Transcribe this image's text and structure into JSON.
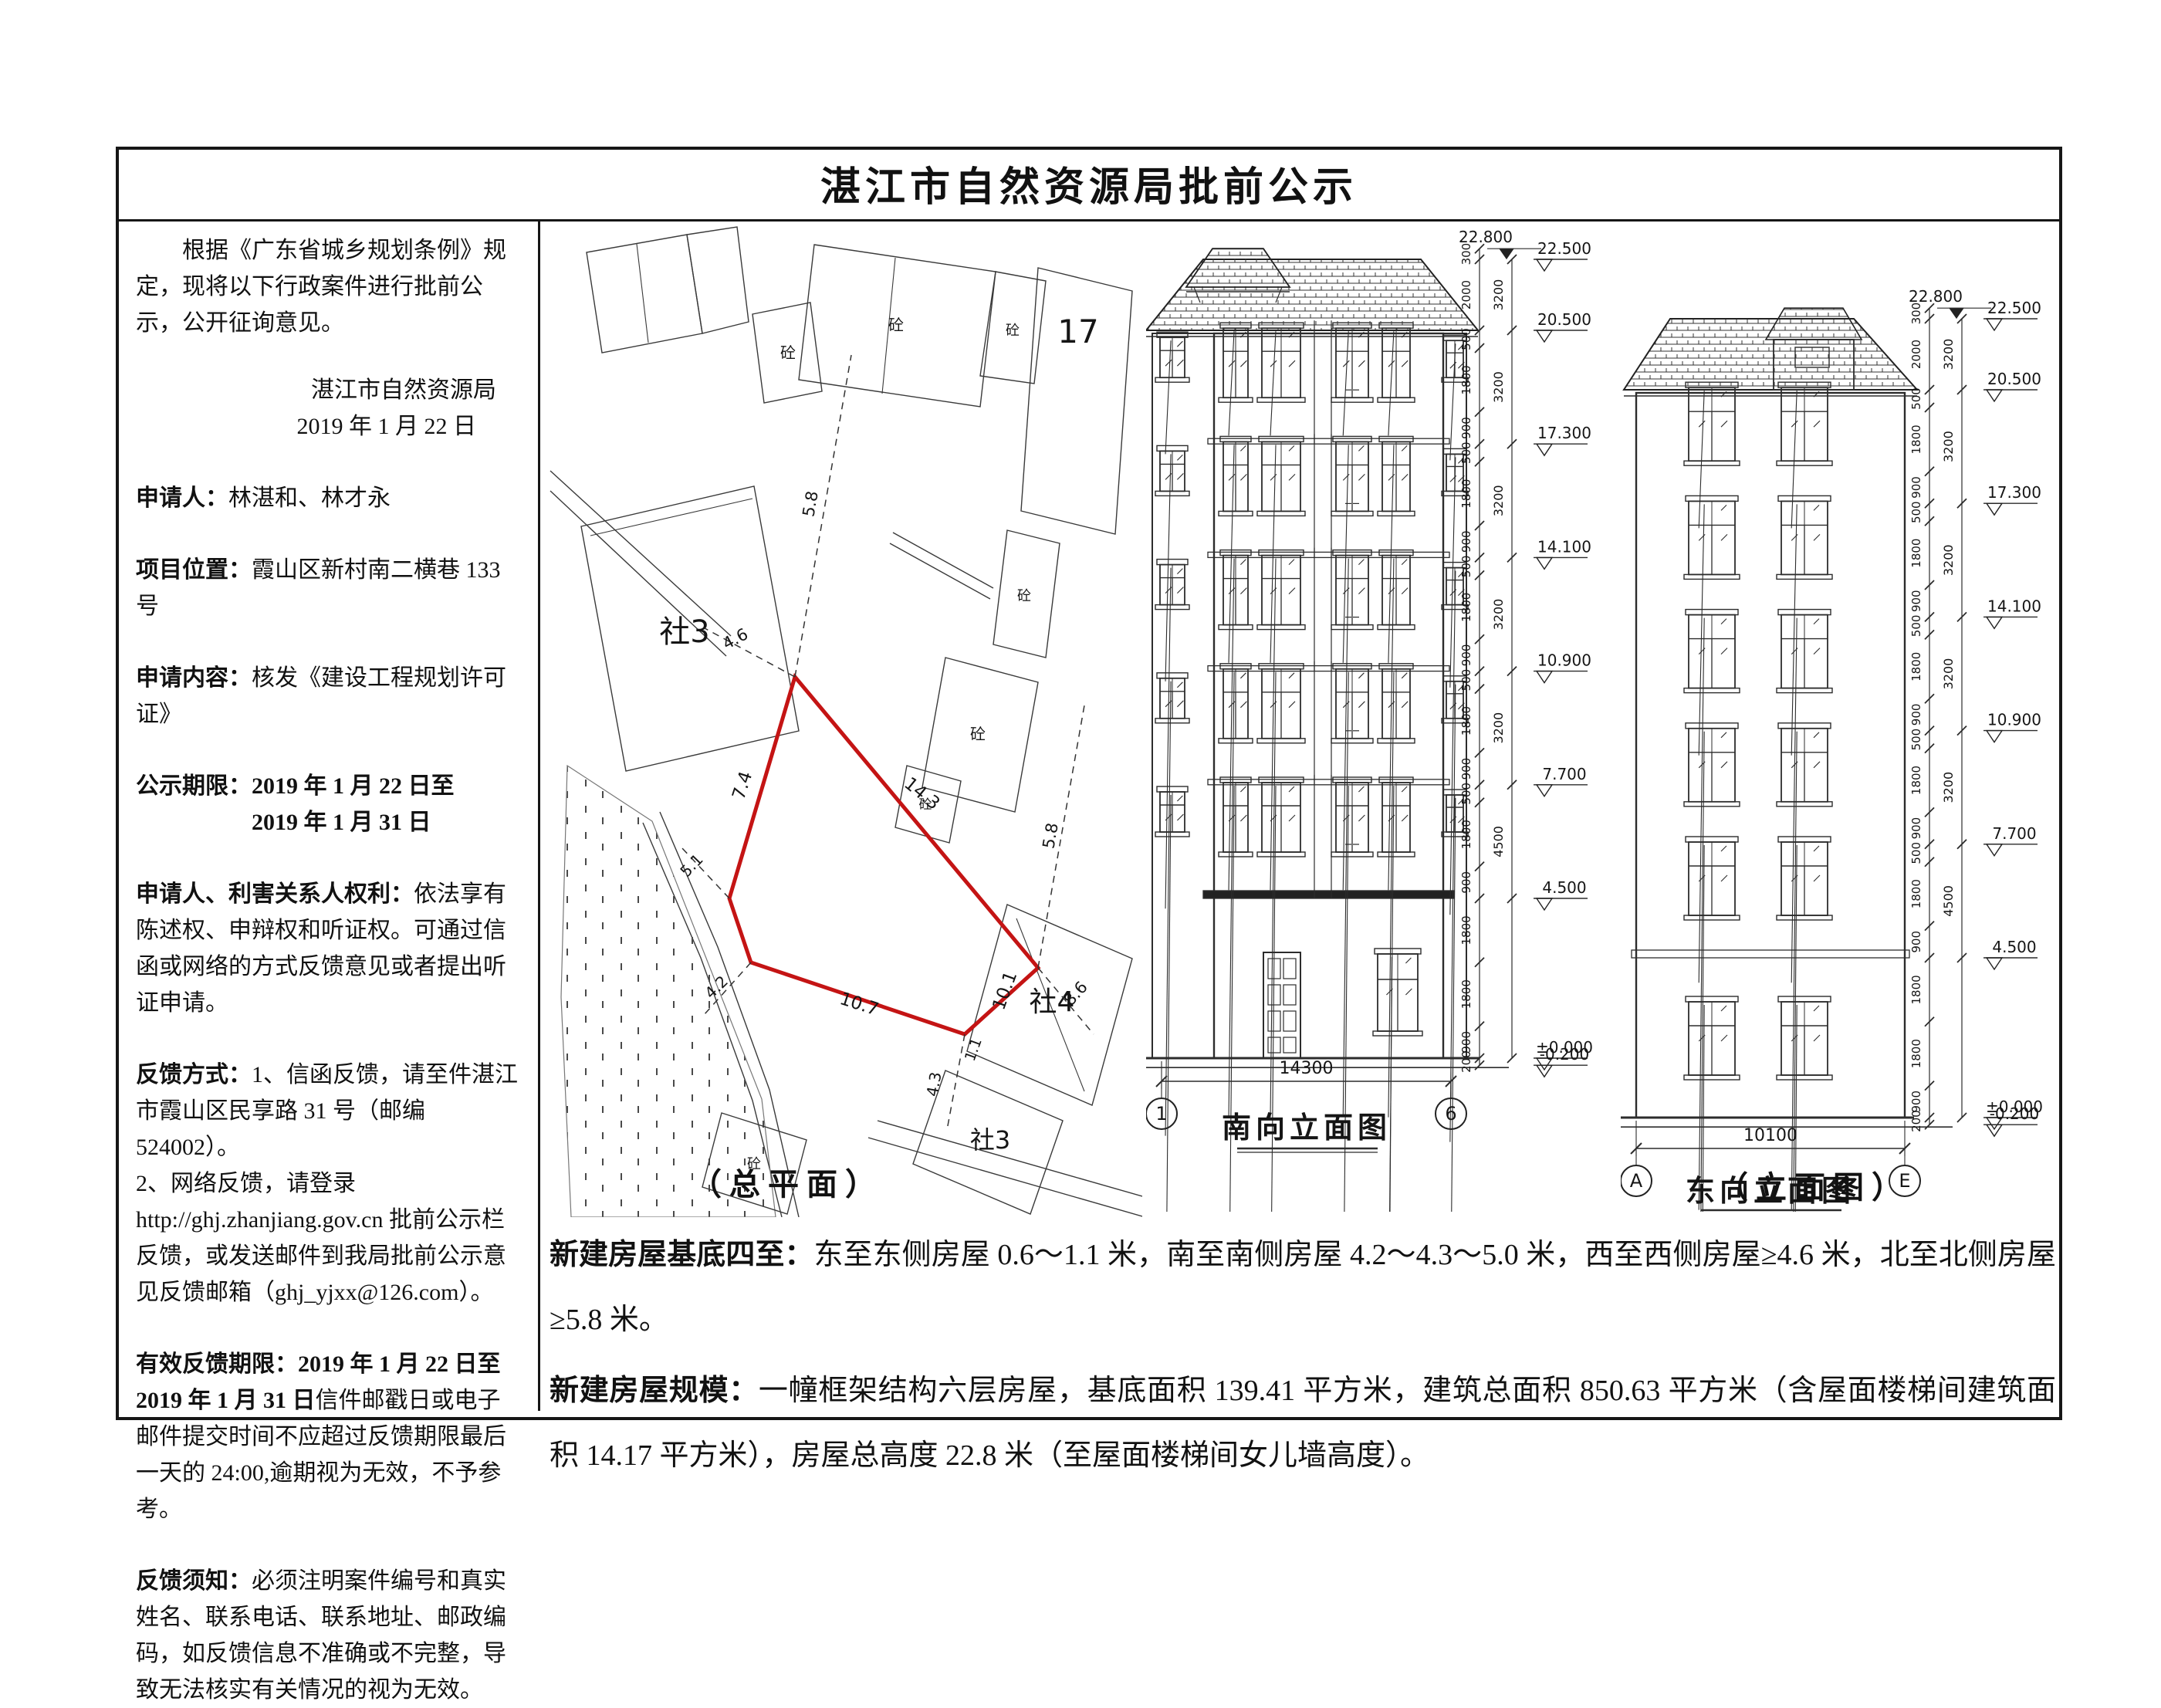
{
  "page": {
    "title": "湛江市自然资源局批前公示"
  },
  "left_panel": {
    "intro": "根据《广东省城乡规划条例》规定，现将以下行政案件进行批前公示，公开征询意见。",
    "issuer": "湛江市自然资源局",
    "issue_date": "2019 年 1 月 22 日",
    "applicant_label": "申请人：",
    "applicant": "林湛和、林才永",
    "location_label": "项目位置：",
    "location": "霞山区新村南二横巷 133 号",
    "content_label": "申请内容：",
    "content": "核发《建设工程规划许可证》",
    "period_label": "公示期限：",
    "period_line1": "2019 年 1 月 22 日至",
    "period_line2": "2019 年 1 月 31 日",
    "rights_label": "申请人、利害关系人权利：",
    "rights": "依法享有陈述权、申辩权和听证权。可通过信函或网络的方式反馈意见或者提出听证申请。",
    "feedback_label": "反馈方式：",
    "feedback_1": "1、信函反馈，请至件湛江市霞山区民享路 31 号（邮编 524002）。",
    "feedback_2": "2、网络反馈，请登录",
    "feedback_3": "http://ghj.zhanjiang.gov.cn 批前公示栏反馈，或发送邮件到我局批前公示意见反馈邮箱（ghj_yjxx@126.com）。",
    "valid_label": "有效反馈期限：",
    "valid_bold": "2019 年 1 月 22 日至 2019 年 1 月 31 日",
    "valid_rest": "信件邮戳日或电子邮件提交时间不应超过反馈期限最后一天的 24:00,逾期视为无效，不予参考。",
    "notice_label": "反馈须知：",
    "notice": "必须注明案件编号和真实姓名、联系电话、联系地址、邮政编码，如反馈信息不准确或不完整，导致无法核实有关情况的视为无效。"
  },
  "site_plan": {
    "caption": "（总平面）",
    "plot_color": "#c41414",
    "edge_dims": {
      "top": "14.3",
      "left": "7.4",
      "bottom": "10.7",
      "right": "10.1",
      "corner": "1.1"
    },
    "offset_dims": {
      "north": "5.8",
      "northeast": "5.8",
      "west": "4.6",
      "east": "8.6",
      "southwest1": "5.1",
      "southwest2": "4.2",
      "south": "4.3"
    },
    "labels": {
      "block3": "社3",
      "block4": "社4",
      "block3b": "社3",
      "num17": "17",
      "concrete": "砼"
    }
  },
  "elevations": {
    "caption_group": "（立面图）",
    "dims": {
      "top": [
        "300",
        "2000"
      ],
      "storey": [
        "500",
        "1800",
        "900"
      ],
      "first": [
        "1800",
        "1800",
        "900"
      ],
      "base": "200",
      "outer": [
        "3200",
        "3200",
        "3200",
        "3200",
        "3200",
        "4500"
      ]
    },
    "south": {
      "caption": "南向立面图",
      "width_dim": "14300",
      "grid_left": "1",
      "grid_right": "6",
      "mark_top": "22.800",
      "marks": [
        "22.500",
        "20.500",
        "17.300",
        "14.100",
        "10.900",
        "7.700",
        "4.500",
        "±0.000",
        "-0.200"
      ]
    },
    "east": {
      "caption": "东向立面图",
      "width_dim": "10100",
      "grid_left": "A",
      "grid_right": "E",
      "mark_top": "22.800",
      "marks": [
        "22.500",
        "20.500",
        "17.300",
        "14.100",
        "10.900",
        "7.700",
        "4.500",
        "±0.000",
        "-0.200"
      ]
    }
  },
  "bottom": {
    "p1_label": "新建房屋基底四至：",
    "p1": "东至东侧房屋 0.6～1.1 米，南至南侧房屋 4.2～4.3～5.0 米，西至西侧房屋≥4.6 米，北至北侧房屋≥5.8 米。",
    "p2_label": "新建房屋规模：",
    "p2": "一幢框架结构六层房屋，基底面积 139.41 平方米，建筑总面积 850.63 平方米（含屋面楼梯间建筑面积 14.17 平方米），房屋总高度 22.8 米（至屋面楼梯间女儿墙高度）。"
  }
}
